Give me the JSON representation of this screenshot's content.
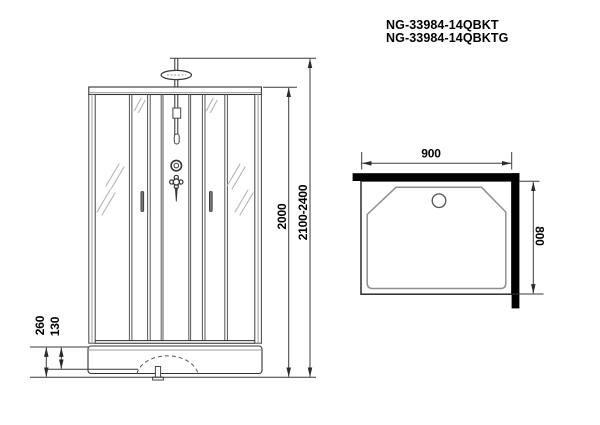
{
  "header": {
    "model_line1": "NG-33984-14QBKT",
    "model_line2": "NG-33984-14QBKTG"
  },
  "front_view": {
    "dim_cabin_height": "2000",
    "dim_total_height": "2100-2400",
    "dim_base_height": "260",
    "dim_tray_step_height": "130"
  },
  "top_view": {
    "dim_width": "900",
    "dim_depth": "800"
  },
  "colors": {
    "background": "#ffffff",
    "outline": "#2b2b2b",
    "secondary_line": "#555555",
    "glass_line": "#9b9b9b",
    "shine": "#b3b3b3",
    "wall_fill": "#000000",
    "text": "#000000"
  }
}
